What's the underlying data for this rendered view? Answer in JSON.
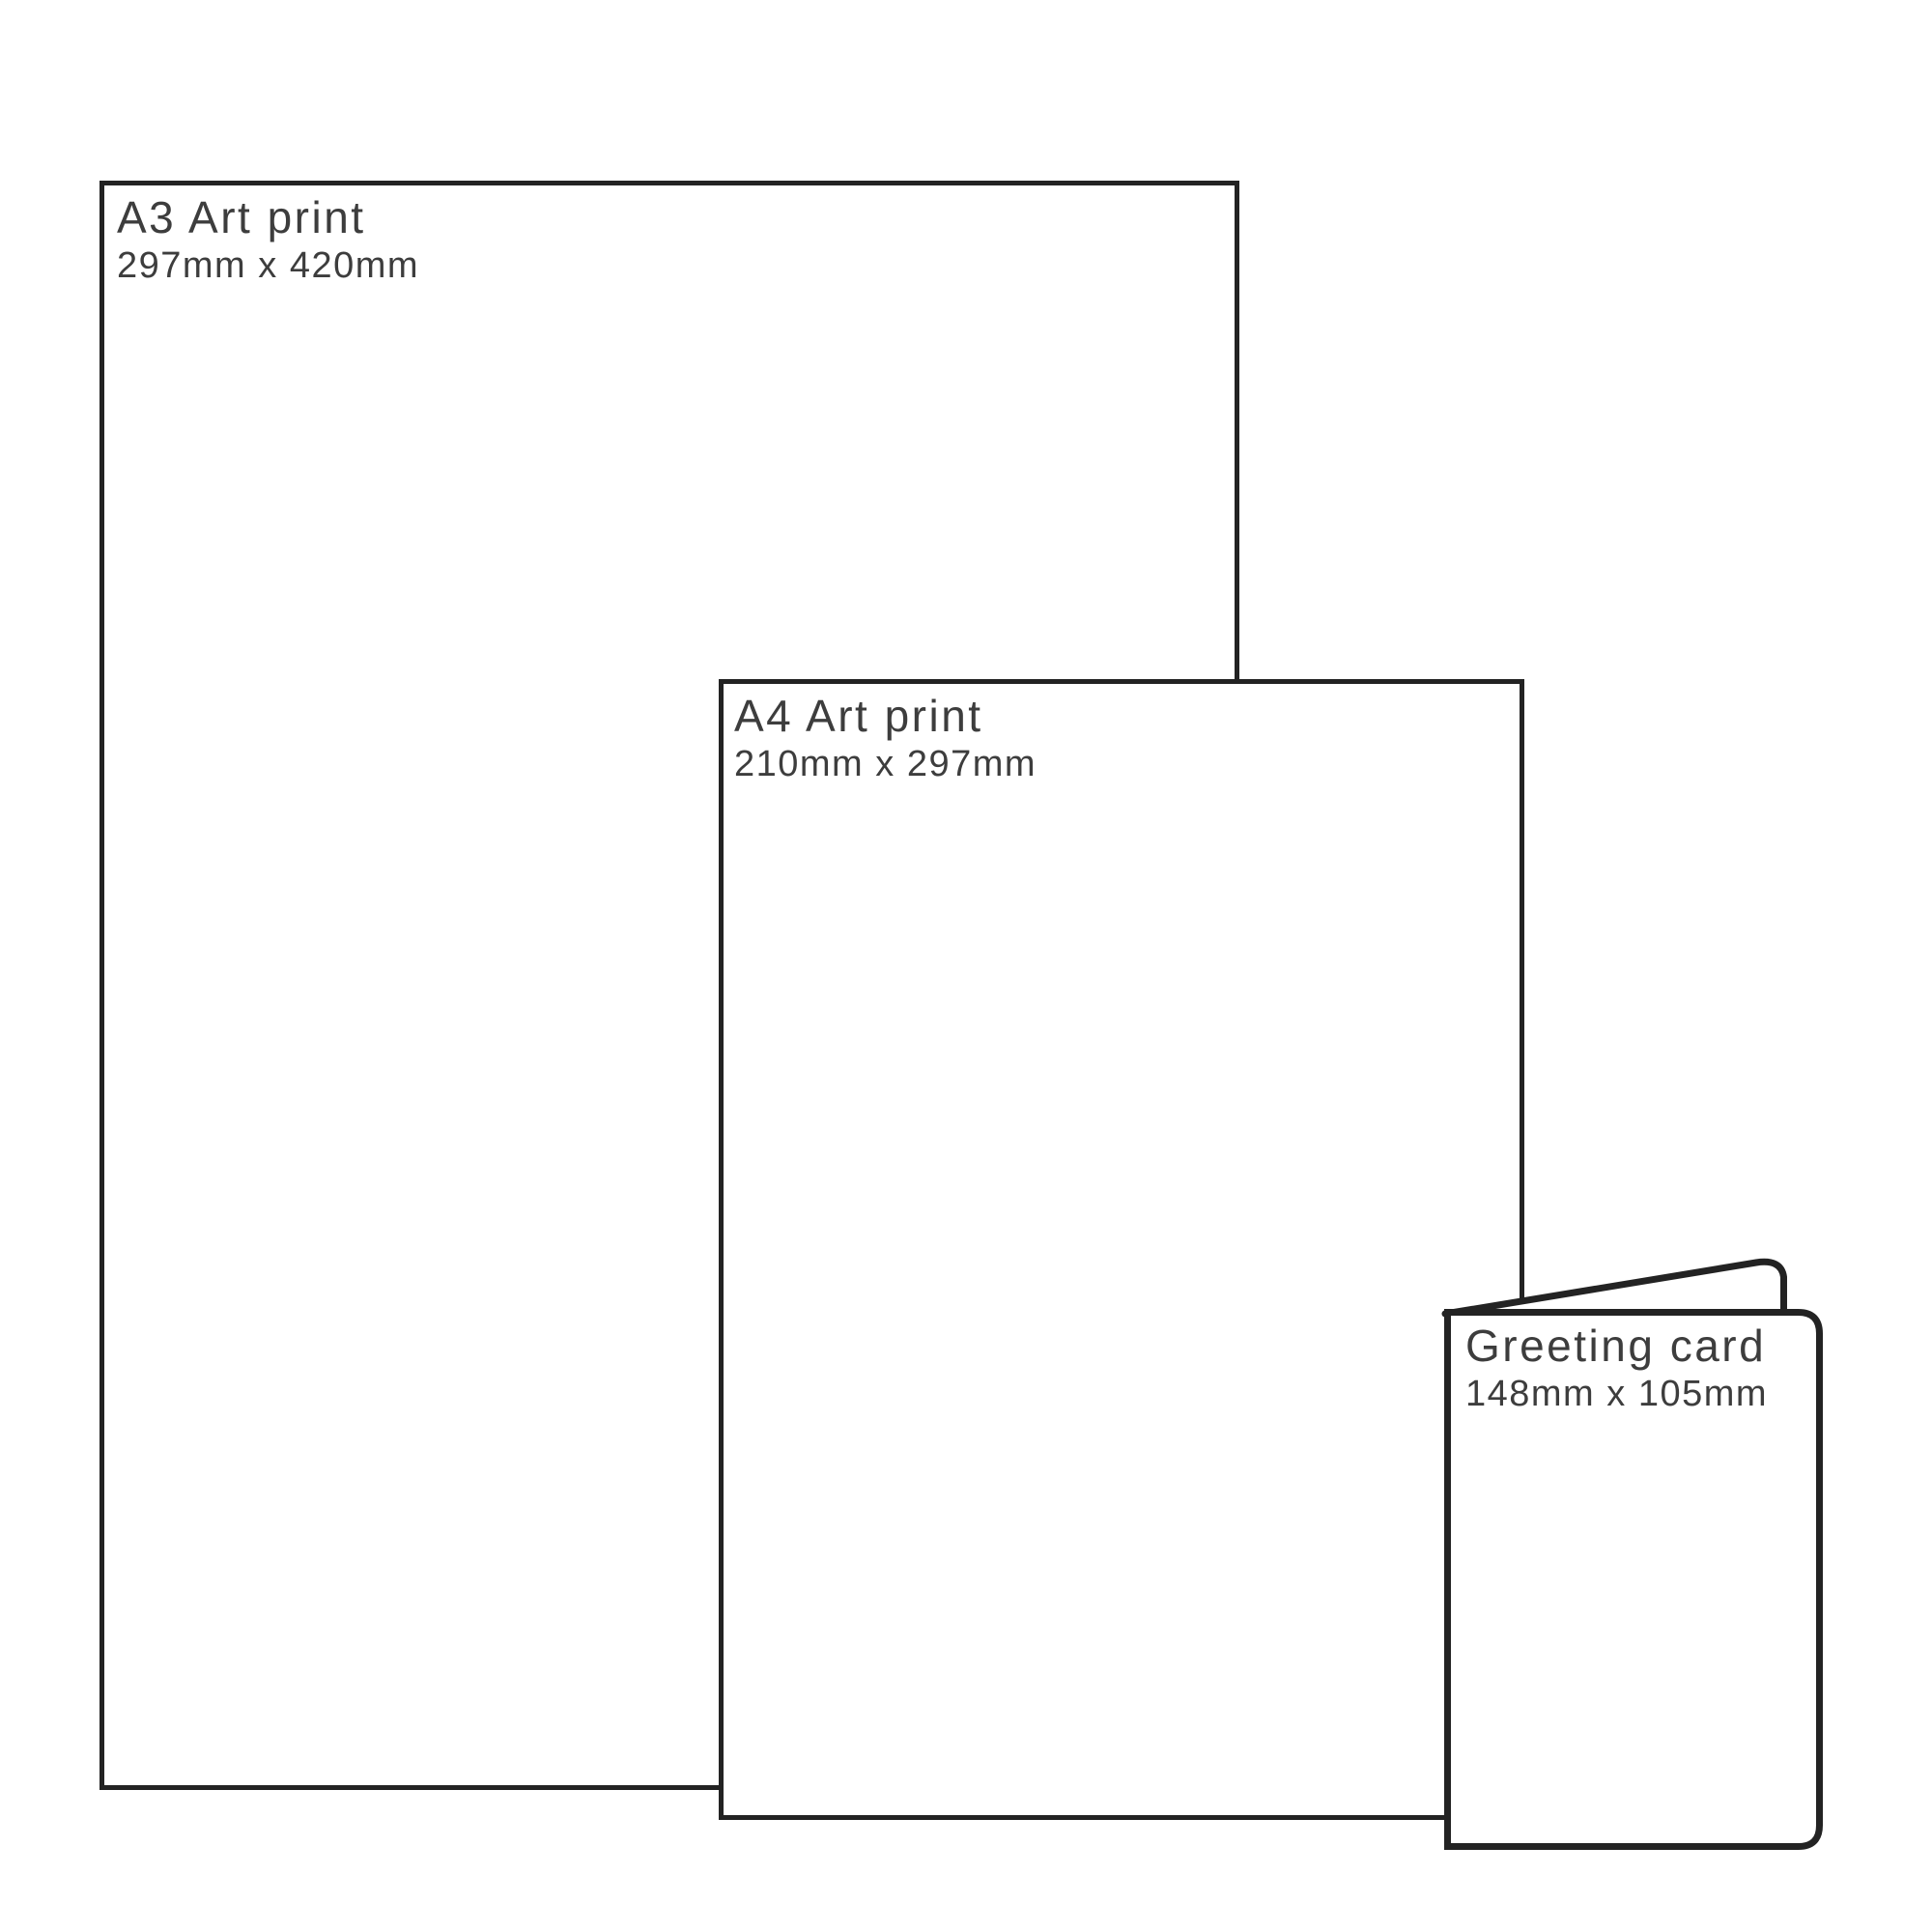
{
  "diagram_title": "Print size comparison",
  "items": [
    {
      "id": "a3",
      "title": "A3 Art print",
      "dimensions": "297mm x 420mm"
    },
    {
      "id": "a4",
      "title": "A4 Art print",
      "dimensions": "210mm x 297mm"
    },
    {
      "id": "card",
      "title": "Greeting card",
      "dimensions": "148mm x 105mm"
    }
  ],
  "colors": {
    "outline": "#232323",
    "label": "#3d3d3d",
    "background": "#ffffff"
  }
}
